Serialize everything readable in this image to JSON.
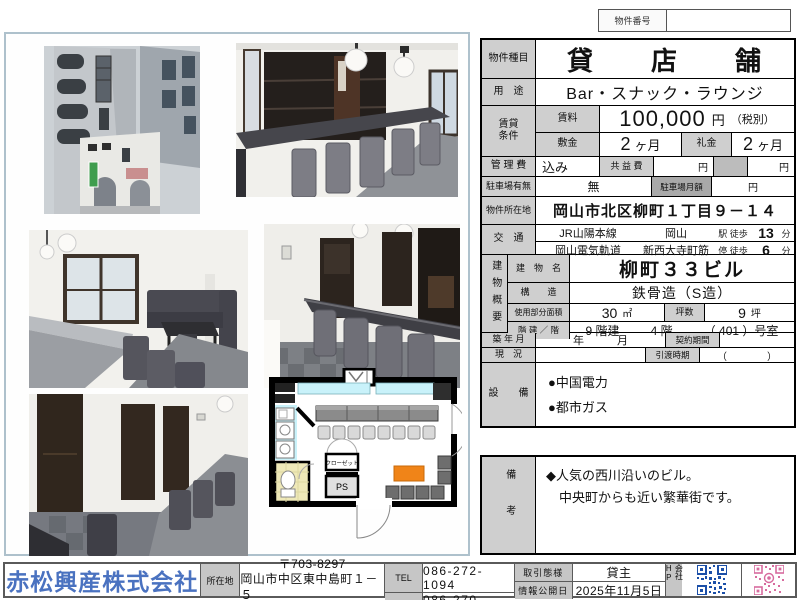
{
  "property_number": {
    "label": "物件番号",
    "value": ""
  },
  "table": {
    "type": {
      "label": "物件種目",
      "value": "貸　　店　　舗"
    },
    "use": {
      "label": "用　途",
      "value": "Bar・スナック・ラウンジ"
    },
    "terms": {
      "label": "賃貸条件",
      "rent": {
        "label": "賃料",
        "value": "100,000",
        "unit": "円",
        "note": "（税別）"
      },
      "deposit": {
        "label": "敷金",
        "value": "2",
        "unit": "ヶ月"
      },
      "key_money": {
        "label": "礼金",
        "value": "2",
        "unit": "ヶ月"
      }
    },
    "management": {
      "label": "管 理 費",
      "value": "込み",
      "common_fee_label": "共 益 費",
      "common_fee_unit": "円",
      "extra_unit": "円"
    },
    "parking": {
      "label": "駐車場有無",
      "value": "無",
      "monthly_label": "駐車場月額",
      "monthly_unit": "円"
    },
    "address": {
      "label": "物件所在地",
      "value": "岡山市北区柳町１丁目９－１４"
    },
    "transport": {
      "label": "交　通",
      "lines": [
        {
          "line": "JR山陽本線",
          "station": "岡山",
          "walk_label": "駅 徒歩",
          "minutes": "13",
          "unit": "分"
        },
        {
          "line": "岡山電気軌道",
          "station": "新西大寺町筋",
          "walk_label": "停 徒歩",
          "minutes": "6",
          "unit": "分"
        }
      ]
    },
    "building": {
      "label": "建物概要",
      "name": {
        "label": "建　物　名",
        "value": "柳町３３ビル"
      },
      "structure": {
        "label": "構　　造",
        "value": "鉄骨造（S造）"
      },
      "area": {
        "label": "使用部分面積",
        "value": "30",
        "unit": "㎡",
        "tsubo_label": "坪数",
        "tsubo_value": "9",
        "tsubo_unit": "坪"
      },
      "floors": {
        "label": "階 建 ／ 階",
        "total": "9 階建",
        "floor": "4 階",
        "room": "（ 401 ）号室"
      }
    },
    "built": {
      "label": "築 年 月",
      "value": "年　　　月",
      "period_label": "契約期間",
      "period_value": ""
    },
    "status": {
      "label": "現　況",
      "value": "",
      "handover_label": "引渡時期",
      "handover_value": "（　　　　）"
    },
    "equipment": {
      "label": "設　　備",
      "items": [
        "●中国電力",
        "●都市ガス"
      ]
    }
  },
  "remarks": {
    "label": "備考",
    "lines": [
      "◆人気の西川沿いのビル。",
      "　中央町からも近い繁華街です。"
    ]
  },
  "floor_plan": {
    "closet_label": "クローゼット",
    "ps_label": "PS"
  },
  "footer": {
    "company": "赤松興産株式会社",
    "location_label": "所在地",
    "postal": "〒703-8297",
    "address": "岡山市中区東中島町１－５",
    "tel_label": "TEL",
    "tel": "086-272-1094",
    "fax_label": "FAX",
    "fax": "086-270-0220",
    "deal_label": "取引態様",
    "deal": "貸主",
    "published_label": "情報公開日",
    "published": "2025年11月5日",
    "hp_label": "会社HP"
  },
  "colors": {
    "accent_blue": "#4a72c0",
    "qr_blue": "#1b4fa8",
    "qr_pink": "#d76b9e",
    "label_gray": "#cfcfcf",
    "panel_border": "#aec1cc",
    "plan_cyan": "#c9f2fa",
    "plan_orange": "#f08418",
    "plan_toilet": "#efe9b8"
  }
}
